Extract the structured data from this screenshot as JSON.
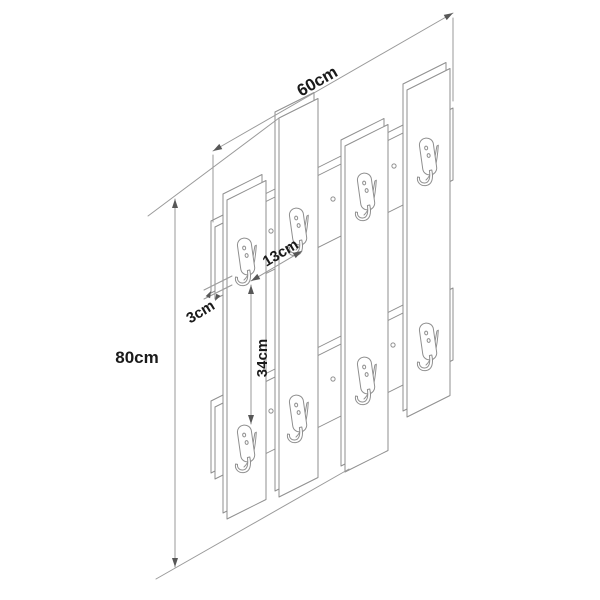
{
  "diagram": {
    "labels": {
      "width": "60cm",
      "height": "80cm",
      "hook_spacing": "13cm",
      "board_thickness": "3cm",
      "hook_row_gap": "34cm"
    },
    "colors": {
      "background": "#ffffff",
      "structure_line": "#8f8f8f",
      "dimension_line": "#9a9a9a",
      "arrow": "#575757",
      "text": "#1a1a1a"
    },
    "parts": {
      "slat_count": 4,
      "hook_count": 8,
      "rail_count": 2,
      "screw_count": 6
    }
  }
}
